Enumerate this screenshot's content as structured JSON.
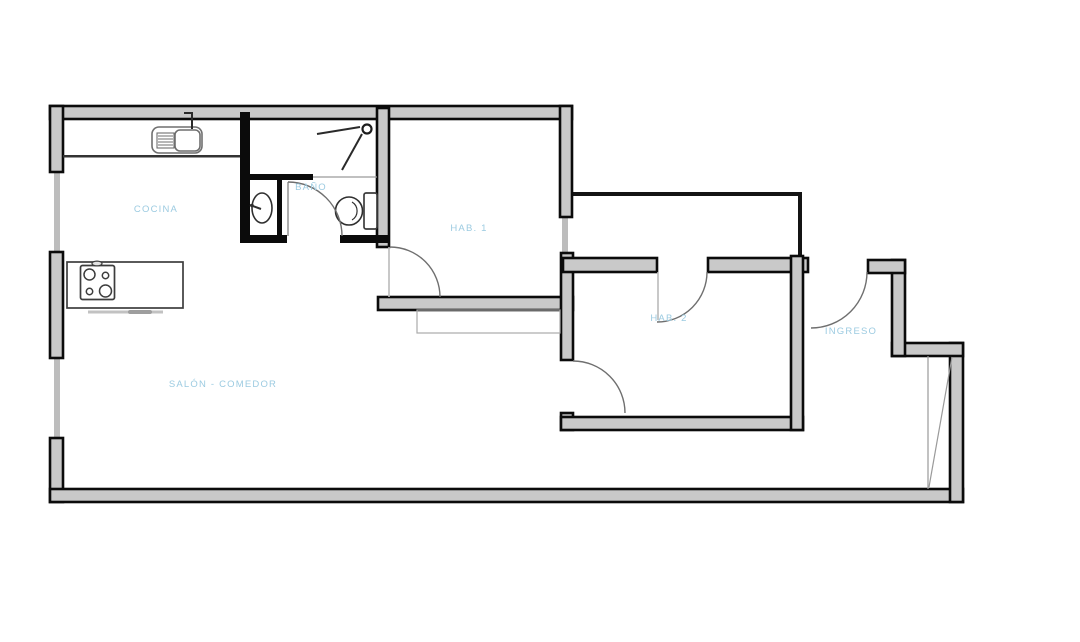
{
  "page": {
    "background": "#ffffff",
    "description_label": "apartment floor plan"
  },
  "colors": {
    "wall_outline": "#0b0b0b",
    "wall_fill": "#c9c9c9",
    "window": "#bdbdbd",
    "label": "#9ccbe1",
    "door_arc": "#6f6f6f",
    "fixture": "#3d3d3d"
  },
  "rooms": [
    {
      "id": "cocina",
      "label": "COCINA"
    },
    {
      "id": "bano",
      "label": "BAÑO"
    },
    {
      "id": "hab1",
      "label": "HAB. 1"
    },
    {
      "id": "hab2",
      "label": "HAB. 2"
    },
    {
      "id": "ingreso",
      "label": "INGRESO"
    },
    {
      "id": "salon-comedor",
      "label": "SALÓN - COMEDOR"
    }
  ],
  "fixtures": [
    {
      "id": "kitchen-sink",
      "name": "kitchen sink with drainboard"
    },
    {
      "id": "stove",
      "name": "4-burner stove on island counter"
    },
    {
      "id": "bathroom-sink",
      "name": "bathroom washbasin"
    },
    {
      "id": "toilet",
      "name": "toilet"
    },
    {
      "id": "shower",
      "name": "shower"
    }
  ]
}
